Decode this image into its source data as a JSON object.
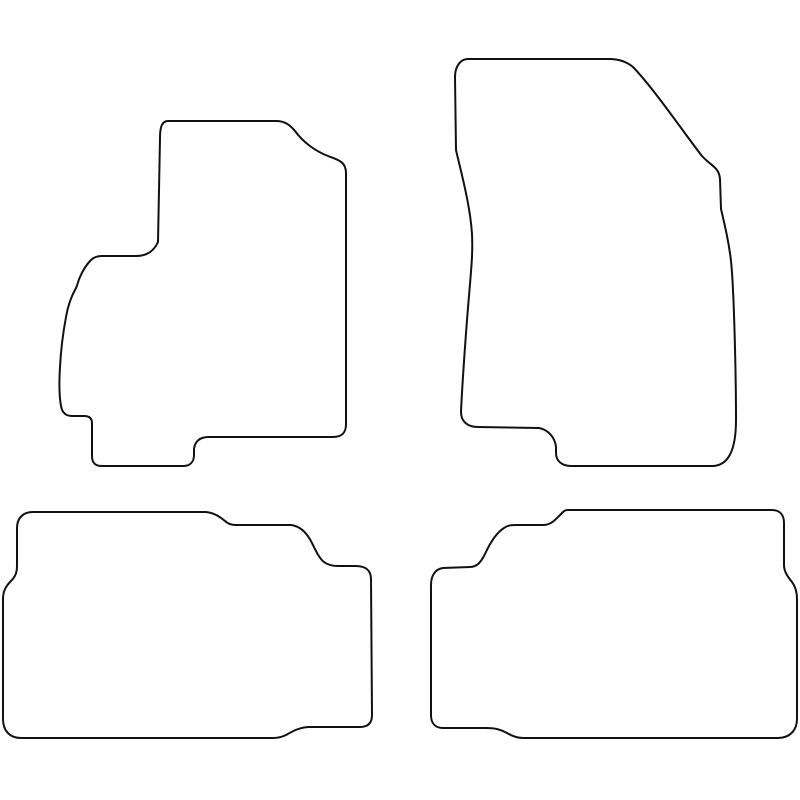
{
  "canvas": {
    "width": 800,
    "height": 800,
    "background_color": "#ffffff"
  },
  "drawing": {
    "stroke_color": "#111111",
    "stroke_width": "2",
    "fill_color": "#ffffff",
    "description": "Outline drawing of a 4-piece tailored car floor mat set: two front mats on top, two rear mats below"
  },
  "mats": [
    {
      "id": "front-left",
      "label": "front-left-mat",
      "path": "M 168 121 L 276 121 C 285 121 290 125 295 131 C 303 142 315 151 328 156 C 339 160 346 162 346 173 L 346 424 C 346 433 342 437 333 437 L 209 437 C 200 437 195 441 194 449 L 194 455 C 194 462 190 466 183 466 L 102 466 C 95 466 92 463 92 456 L 92 423 C 92 418 89 416 84 416 L 72 416 C 65 416 62 412 61 406 C 59 395 59 383 60 367 C 61 348 63 333 66 317 C 68 305 72 295 76 288 C 78 284 78 281 80 277 C 83 270 86 265 91 260 C 94 257 97 256 102 256 L 136 256 C 147 256 154 251 158 242 L 160 138 C 160 127 162 121 168 121 Z"
    },
    {
      "id": "front-right",
      "label": "front-right-mat",
      "path": "M 468 59 L 609 59 C 620 59 627 62 633 67 C 655 90 684 133 702 156 C 711 166 719 167 720 179 L 721 209 C 725 226 729 243 731 261 C 734 289 736 375 736 420 C 736 446 730 466 712 466 L 571 466 C 562 466 556 461 556 453 L 556 447 C 555 438 549 430 539 428 L 478 427 C 467 427 461 421 461 412 C 462 388 466 330 469 296 C 471 271 473 254 472 234 C 470 204 461 172 456 150 L 455 77 C 455 67 460 59 468 59 Z"
    },
    {
      "id": "rear-left",
      "label": "rear-left-mat",
      "path": "M 33 512 L 206 512 C 215 513 220 517 225 521 C 228 524 231 525 236 525 L 291 525 C 300 526 307 533 312 543 C 316 551 319 558 324 562 C 328 565 332 566 338 566 L 356 566 C 365 566 371 570 371 579 L 372 715 C 372 723 368 727 360 727 L 310 727 C 300 727 293 731 286 735 C 282 737 278 738 273 738 L 21 738 C 10 738 3 731 3 719 L 3 599 C 3 591 6 586 11 581 C 15 577 17 573 17 566 L 17 528 C 17 518 23 512 33 512 Z"
    },
    {
      "id": "rear-right",
      "label": "rear-right-mat",
      "path": "M 568 510 L 772 510 C 780 510 784 515 784 523 L 784 565 C 784 572 788 577 792 582 C 795 586 797 591 797 599 L 797 719 C 797 730 790 738 778 738 L 523 738 C 517 738 512 736 507 733 C 500 729 494 728 486 728 L 443 728 C 435 728 431 723 431 715 L 431 585 C 431 576 435 569 443 568 L 470 567 C 477 567 481 562 485 554 C 490 543 496 533 504 528 C 508 525 512 525 517 525 L 543 525 C 552 525 557 518 562 513 C 564 511 565 510 568 510 Z"
    }
  ]
}
